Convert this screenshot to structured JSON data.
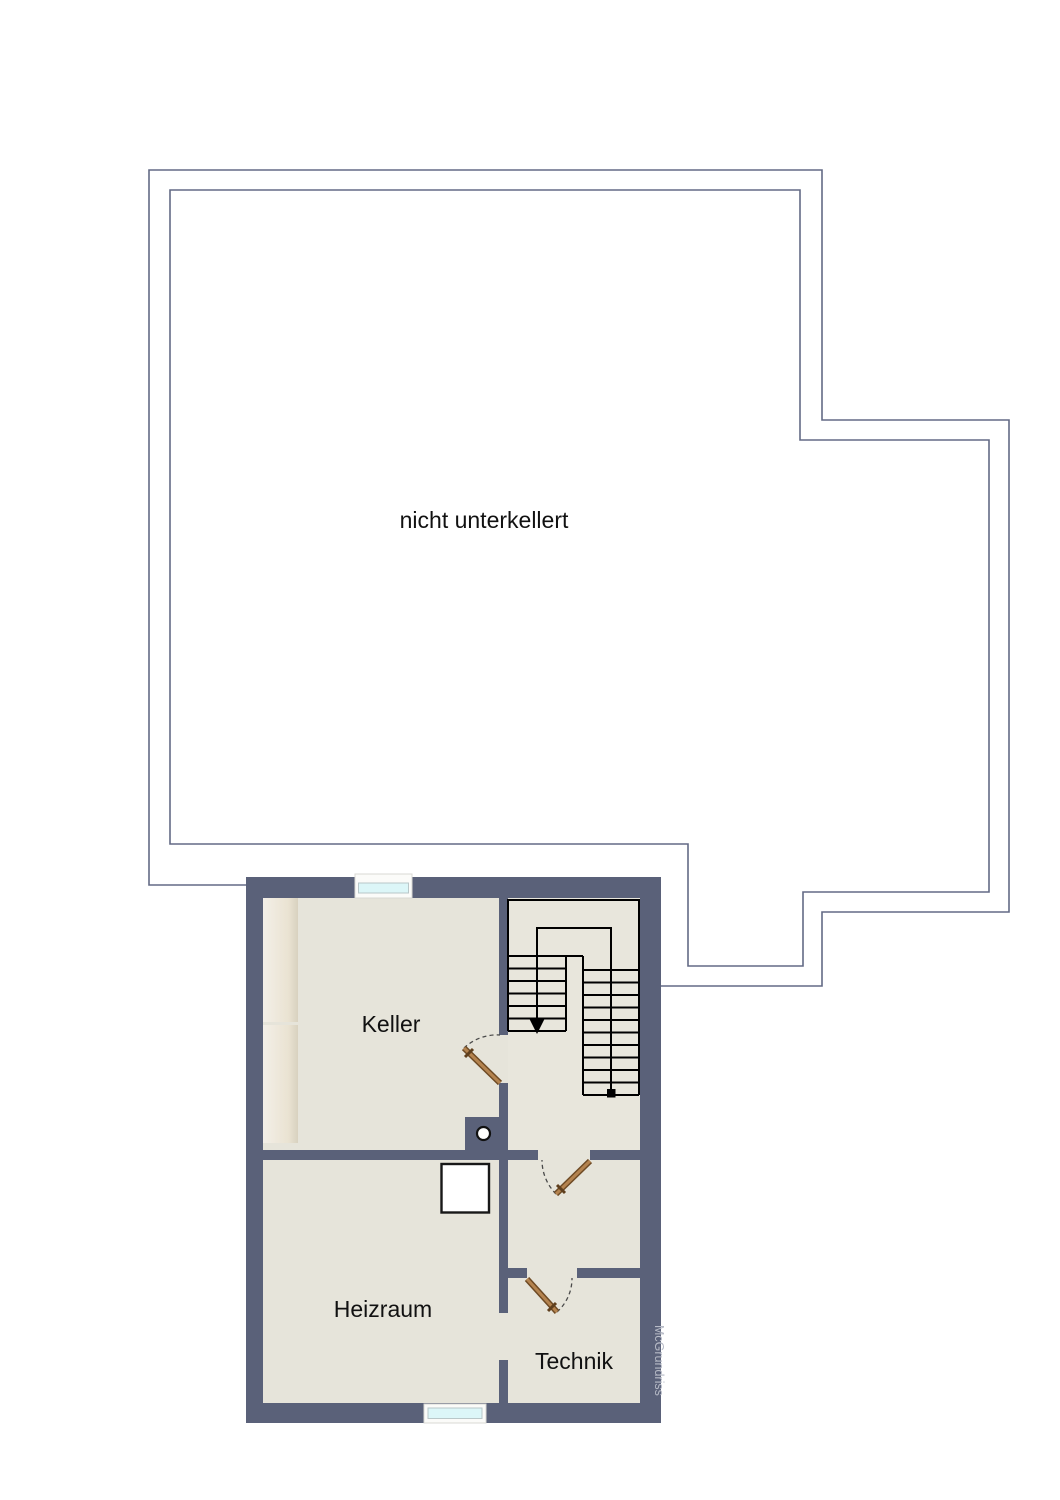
{
  "annotation": {
    "label": "nicht unterkellert"
  },
  "rooms": [
    {
      "id": "keller",
      "label": "Keller"
    },
    {
      "id": "heizraum",
      "label": "Heizraum"
    },
    {
      "id": "technik",
      "label": "Technik"
    }
  ],
  "watermark": {
    "label": "McGrundriss"
  },
  "colors": {
    "wall": "#5a6179",
    "floor": "#e6e4da",
    "outline": "#636a85",
    "stair_line": "#000000",
    "door_leaf_dark": "#6e4a24",
    "door_leaf_light": "#b4834f",
    "window_glass": "#dcf6f8",
    "window_frame": "#fbfbf9",
    "label_text": "#111111",
    "watermark_text": "#b6bac6"
  }
}
